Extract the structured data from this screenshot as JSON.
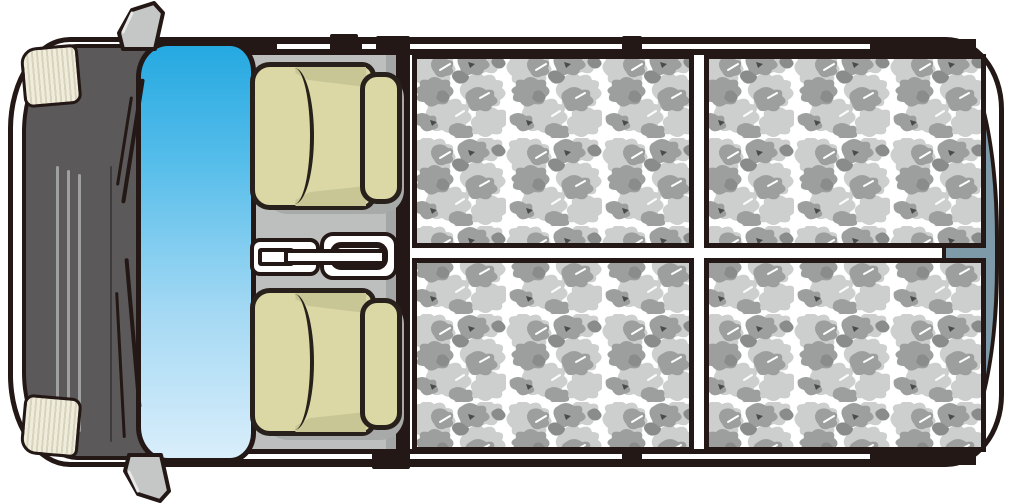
{
  "meta": {
    "title": "Van interior top view illustration",
    "type": "vehicle-layout-diagram",
    "text_content": "none"
  },
  "vehicle": {
    "view": "top-down",
    "front": {
      "parts": [
        "front-bumper",
        "hood",
        "grille-lines",
        "headlight-upper",
        "headlight-lower",
        "windshield",
        "wiper-upper",
        "wiper-lower",
        "side-mirror-upper",
        "side-mirror-lower"
      ],
      "grille_line_count": 3
    },
    "cab": {
      "seats": [
        {
          "id": "seat-upper",
          "parts": [
            "cushion",
            "seam",
            "headrest"
          ]
        },
        {
          "id": "seat-lower",
          "parts": [
            "cushion",
            "seam",
            "headrest"
          ]
        }
      ],
      "console_parts": [
        "console-tray",
        "console-pad",
        "shift-ring",
        "slot",
        "lever-bar"
      ]
    },
    "cargo": {
      "surface": "gray-camouflage",
      "grid": {
        "rows": 2,
        "cols": 2
      },
      "panel_count": 4,
      "parts": [
        "rear-window-strip"
      ]
    }
  },
  "colors": {
    "outline": "#231815",
    "hood": "#5b5959",
    "body-white": "#ffffff",
    "floor": "#bdbebe",
    "floor-shade": "#a4a5a5",
    "windshield-top": "#25a9e1",
    "windshield-bottom": "#d9eefb",
    "seat": "#dbd8a6",
    "seat-shade": "#c9c695",
    "headlight": "#f0ecdb",
    "headlight-stripe": "#d8d3bc",
    "camo-bg": "#ffffff",
    "camo-light": "#cdcece",
    "camo-mid": "#9d9e9e",
    "camo-dark": "#8a8b8b",
    "rear-window": "#7e99a8",
    "mirror": "#c5c6c6"
  }
}
